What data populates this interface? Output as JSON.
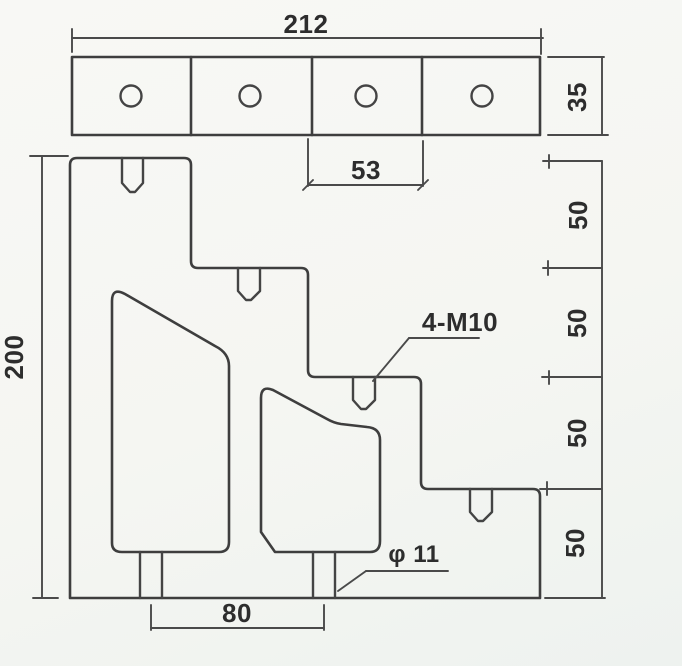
{
  "drawing": {
    "colors": {
      "background": "#f5f6f2",
      "line": "#3e3e3e",
      "text": "#2d2d2d"
    },
    "dimensions": {
      "total_width": "212",
      "bar_height": "35",
      "hole_pitch": "53",
      "overall_height": "200",
      "step_heights": [
        "50",
        "50",
        "50",
        "50"
      ],
      "slot_center_distance": "80",
      "thread_callout": "4-M10",
      "hole_diameter_callout": "φ 11"
    }
  }
}
